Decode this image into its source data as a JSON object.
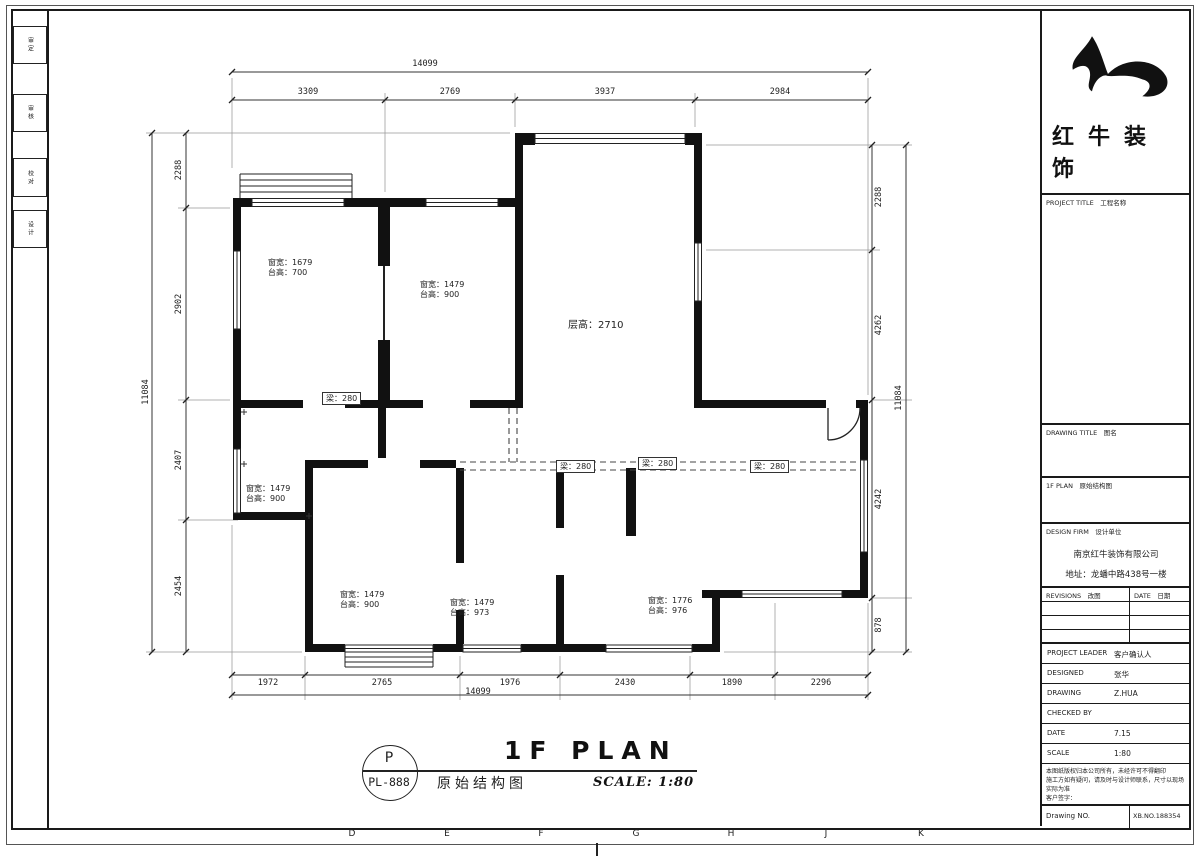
{
  "sheet": {
    "grid_letters": [
      "D",
      "E",
      "F",
      "G",
      "H",
      "J",
      "K"
    ],
    "left_strip_labels": [
      "审定",
      "审核",
      "校对",
      "设计"
    ]
  },
  "plan": {
    "floor_height": "层高：2710",
    "beams": [
      "梁：280",
      "梁：280",
      "梁：280",
      "梁：280"
    ],
    "windows": [
      {
        "w": "窗宽：1679",
        "s": "台高：700"
      },
      {
        "w": "窗宽：1479",
        "s": "台高：900"
      },
      {
        "w": "窗宽：1479",
        "s": "台高：900"
      },
      {
        "w": "窗宽：1479",
        "s": "台高：900"
      },
      {
        "w": "窗宽：1479",
        "s": "台高：973"
      },
      {
        "w": "窗宽：1776",
        "s": "台高：976"
      }
    ],
    "dims": {
      "top_overall": "14099",
      "top": [
        "3309",
        "2769",
        "3937",
        "2984"
      ],
      "bottom": [
        "1972",
        "2765",
        "1976",
        "2430",
        "1890",
        "2296"
      ],
      "bottom_overall": "14099",
      "left": [
        "2288",
        "2902",
        "2407",
        "2454"
      ],
      "left_overall": "11084",
      "right": [
        "2288",
        "4262",
        "4242",
        "878"
      ],
      "right_overall": "11084"
    }
  },
  "titlebar": {
    "tag_letter": "P",
    "tag_number": "PL-888",
    "drawing_name": "原始结构图",
    "title": "1F PLAN",
    "scale": "SCALE: 1:80"
  },
  "titleblock": {
    "brand_line1": "红牛装",
    "brand_line2": "饰",
    "project_title": "PROJECT TITLE　工程名称",
    "drawing_title": "DRAWING TITLE　图名",
    "release_row": "1F PLAN　原始结构图",
    "design_firm": "DESIGN FIRM　设计单位",
    "company": "南京红牛装饰有限公司",
    "address": "地址：龙蟠中路438号一楼",
    "rev_label": "REVISIONS　改图",
    "rev_date": "DATE　日期",
    "rows": [
      {
        "label": "PROJECT LEADER",
        "value": "客户确认人"
      },
      {
        "label": "DESIGNED",
        "value": "张华"
      },
      {
        "label": "DRAWING",
        "value": "Z.HUA"
      },
      {
        "label": "CHECKED BY",
        "value": ""
      },
      {
        "label": "DATE",
        "value": "7.15"
      },
      {
        "label": "SCALE",
        "value": "1:80"
      }
    ],
    "notes": [
      "本图纸版权归本公司所有，未经许可不得翻印",
      "施工方如有疑问，请及时与设计师联系，尺寸以现场实际为准",
      "客户签字："
    ],
    "drawing_no_label": "Drawing NO.",
    "drawing_no_value": "XB.NO.188354"
  }
}
